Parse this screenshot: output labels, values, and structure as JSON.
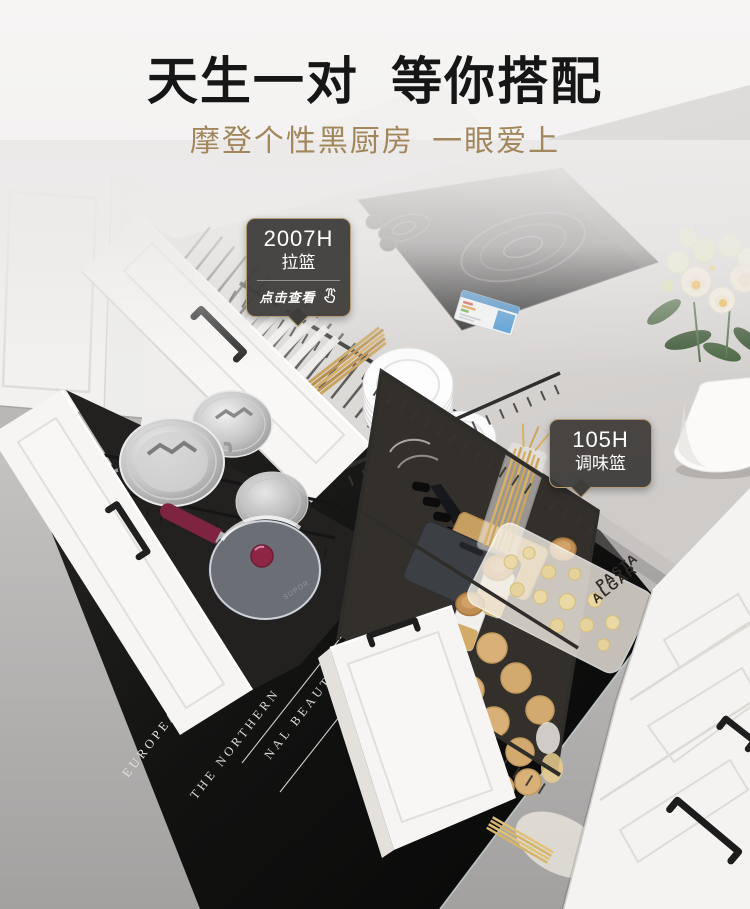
{
  "page": {
    "title": "天生一对 等你搭配",
    "subtitle": "摩登个性黑厨房 一眼爱上"
  },
  "callouts": {
    "pull_basket": {
      "model": "2007H",
      "name": "拉篮",
      "cta": "点击查看"
    },
    "spice_basket": {
      "model": "105H",
      "name": "调味篮"
    }
  },
  "scene": {
    "mat_text_primary": "EUROPEAN ART DESIGN STYLE",
    "mat_text_secondary": "THE NORTHERN",
    "mat_text_tertiary": "NAL BEAUTY",
    "pan_brand": "SUPOR",
    "pasta_bag_line1": "PASTA",
    "pasta_bag_line2": "ALGAR"
  },
  "colors": {
    "accent_gold": "#b59b72",
    "callout_bg": "#3e3c39",
    "title_black": "#161616",
    "subtitle_gold": "#a2865c"
  }
}
